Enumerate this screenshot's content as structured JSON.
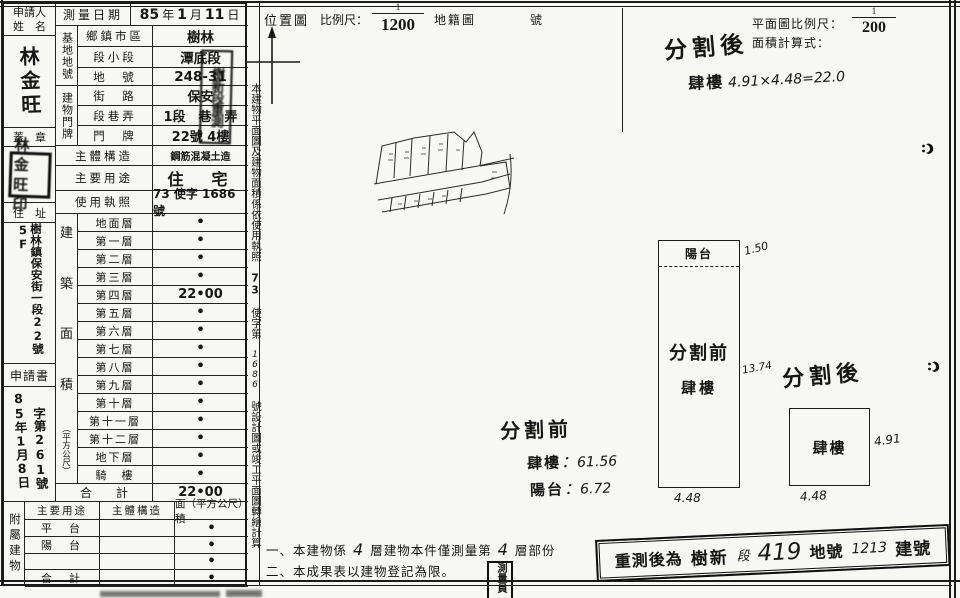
{
  "applicant": {
    "label_line1": "申請人",
    "label_line2": "姓　名",
    "name": "林金旺",
    "seal_label": "蓋　章",
    "seal_text": "林金旺印",
    "address_label": "住　址",
    "address": "樹林鎮保安街一段22號5F",
    "application_label": "申請書",
    "application_date": "85年1月8日",
    "application_no": "字第261號"
  },
  "survey": {
    "label": "測量日期",
    "y": "85",
    "y_unit": "年",
    "m": "1",
    "m_unit": "月",
    "d": "11",
    "d_unit": "日"
  },
  "land": {
    "group_label": "基地地號",
    "rows": [
      {
        "label": "鄉鎮市區",
        "value": "樹林"
      },
      {
        "label": "段小段",
        "value": "潭底段"
      },
      {
        "label": "地　號",
        "value": "248-31"
      }
    ]
  },
  "door": {
    "group_label": "建物門牌",
    "rows": [
      {
        "label": "街　路",
        "value": "保安"
      },
      {
        "label": "段巷弄",
        "value": "1段　巷　弄"
      },
      {
        "label": "門　牌",
        "value": "22號 4樓"
      }
    ]
  },
  "overlap_stamp": "樹新段重測",
  "structure": {
    "label": "主體構造",
    "value": "鋼筋混凝土造"
  },
  "usage": {
    "label": "主要用途",
    "value": "住　宅"
  },
  "license": {
    "label": "使用執照",
    "value": "73 使字 1686 號"
  },
  "area_col": {
    "c1": "建",
    "c2": "築",
    "c3": "面",
    "c4": "積",
    "unit": "（平方公尺）"
  },
  "floors": [
    {
      "label": "地面層",
      "value": "•"
    },
    {
      "label": "第一層",
      "value": "•"
    },
    {
      "label": "第二層",
      "value": "•"
    },
    {
      "label": "第三層",
      "value": "•"
    },
    {
      "label": "第四層",
      "value": "22•00"
    },
    {
      "label": "第五層",
      "value": "•"
    },
    {
      "label": "第六層",
      "value": "•"
    },
    {
      "label": "第七層",
      "value": "•"
    },
    {
      "label": "第八層",
      "value": "•"
    },
    {
      "label": "第九層",
      "value": "•"
    },
    {
      "label": "第十層",
      "value": "•"
    },
    {
      "label": "第十一層",
      "value": "•"
    },
    {
      "label": "第十二層",
      "value": "•"
    },
    {
      "label": "地下層",
      "value": "•"
    },
    {
      "label": "騎　樓",
      "value": "•"
    }
  ],
  "total": {
    "label": "合　　計",
    "value": "22•00"
  },
  "annex": {
    "group_label": "附屬建物",
    "header_use": "主要用途",
    "header_structure": "主體構造",
    "header_area": "面（平方公尺）積",
    "rows": [
      {
        "label": "平　台",
        "value": "•"
      },
      {
        "label": "陽　台",
        "value": "•"
      },
      {
        "label": "",
        "value": "•"
      },
      {
        "label": "合　計",
        "value": "•"
      }
    ]
  },
  "side_note": {
    "p1": "本建物平面圖及建物面積係依使用執照",
    "h1": "73",
    "p2": "使字第",
    "h2": "1686",
    "p3": "號設計圖或竣工平面圖轉繪計算"
  },
  "location": {
    "title": "位置圖",
    "scale_label": "比例尺：",
    "num": "1",
    "den": "1200",
    "cadastre": "地籍圖",
    "no": "號"
  },
  "plan_header": {
    "scale_label": "平面圖比例尺：",
    "num": "1",
    "den": "200",
    "formula_label": "面積計算式：",
    "after_title": "分割後",
    "after_floor": "肆樓",
    "after_calc": "4.91×4.48=22.0"
  },
  "before_plan": {
    "balcony": "陽台",
    "dim_top": "1.50",
    "title": "分割前",
    "floor": "肆樓",
    "dim_side": "13.74",
    "dim_bottom": "4.48"
  },
  "after_plan": {
    "title": "分割後",
    "floor": "肆樓",
    "dim_side": "4.91",
    "dim_bottom": "4.48"
  },
  "before_area": {
    "title": "分割前",
    "floor_label": "肆樓",
    "floor_value": "61.56",
    "balcony_label": "陽台",
    "balcony_value": "6.72"
  },
  "notes": {
    "n1_a": "一、本建物係",
    "n1_b": "4",
    "n1_c": "層建物本件僅測量第",
    "n1_d": "4",
    "n1_e": "層部份",
    "n2": "二、本成果表以建物登記為限。"
  },
  "restamp": {
    "p1": "重測後為",
    "p2": "樹新",
    "h1": "段",
    "h2": "419",
    "p3": "地號",
    "h3": "1213",
    "p4": "建號"
  },
  "surveyor": "測量員"
}
